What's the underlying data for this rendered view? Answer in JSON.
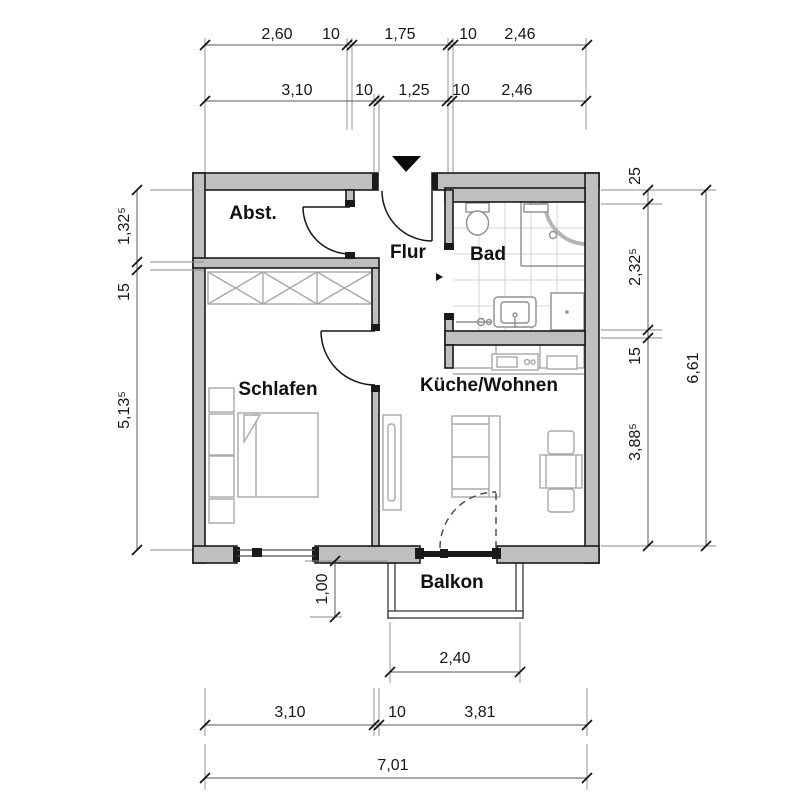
{
  "title": "Wohnung Grundriss",
  "colors": {
    "wall": "#bfbfbf",
    "outline": "#1a1a1a",
    "tile": "#d4d4d4",
    "fixture": "#8f8f8f",
    "furniture": "#a8a8a8"
  },
  "rooms": {
    "storage": "Abst.",
    "hall": "Flur",
    "bath": "Bad",
    "bedroom": "Schlafen",
    "living": "Küche/Wohnen",
    "balcony": "Balkon"
  },
  "dims": {
    "top1": [
      "2,60",
      "10",
      "1,75",
      "10",
      "2,46"
    ],
    "top2": [
      "3,10",
      "10",
      "1,25",
      "10",
      "2,46"
    ],
    "left": [
      "1,32⁵",
      "15",
      "5,13⁵"
    ],
    "right_inner": [
      "25",
      "2,32⁵",
      "15",
      "3,88⁵"
    ],
    "right_total": "6,61",
    "bottom1": [
      "3,10",
      "10",
      "3,81"
    ],
    "bottom_total": "7,01",
    "balcony_width": "2,40",
    "balcony_depth": "1,00"
  }
}
